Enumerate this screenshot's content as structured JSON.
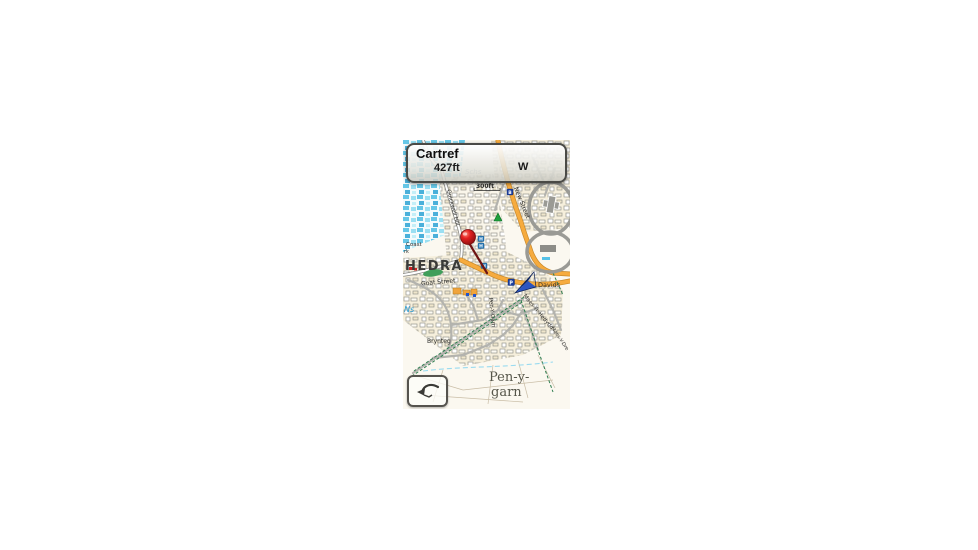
{
  "banner": {
    "title": "Cartref",
    "elevation": "427ft",
    "direction": "W"
  },
  "map": {
    "scale_label": "300ft",
    "place_labels": {
      "city_fragment": "HEDRA",
      "coast": "Coast",
      "coast_fragment": "rk",
      "schools_fragment": "Schs",
      "water_fragment": "Ns",
      "estate": "Brynteg",
      "davids": "Davids",
      "settlement_line1": "Pen-y-",
      "settlement_line2": "garn"
    },
    "street_labels": {
      "goat_street": "Goat Street",
      "quickwell_hill": "Quickwell Hill",
      "new_street": "New Street",
      "pen_y_garn": "Pen-Y-Garn",
      "maes_yr_hedydd": "Maes-Yr-Hedydd",
      "maes_y_dre": "Maes-Y-Dre"
    },
    "poi_icons": {
      "hotel1": "H",
      "hotel2": "H",
      "hotel3": "H",
      "lodging": "B",
      "parking": "P"
    }
  },
  "colors": {
    "road_primary": "#f6ab3e",
    "road_primary_casing": "#c8882a",
    "position_arrow": "#16337e",
    "pin_red": "#d41f1f",
    "water_blue": "#56c3e8",
    "path_green": "#2e7d4f"
  }
}
